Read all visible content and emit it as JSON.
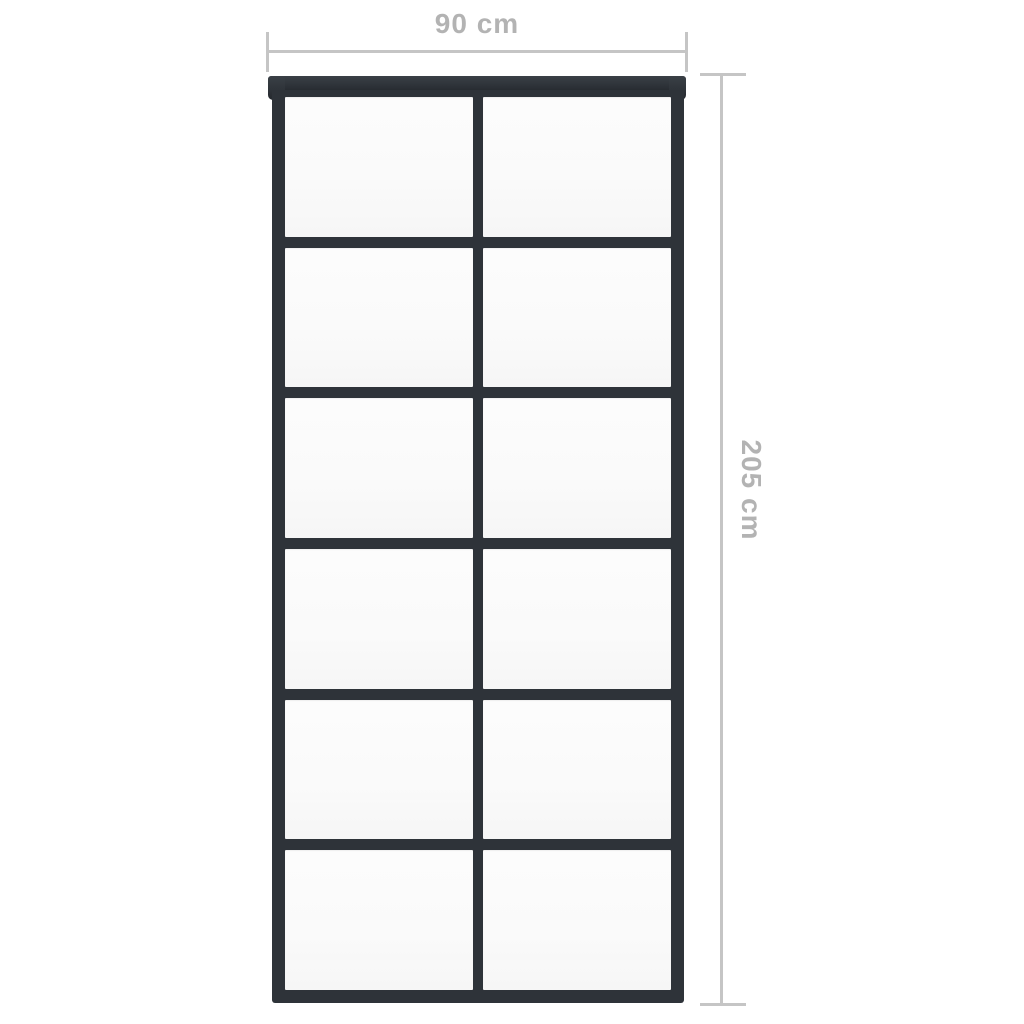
{
  "diagram": {
    "kind": "product-dimension-diagram",
    "subject": "sliding door with black frame and glass panes",
    "grid": {
      "rows": 6,
      "columns": 2,
      "pane_count": 12
    }
  },
  "dimensions": {
    "width": {
      "label": "90 cm",
      "value": 90,
      "unit": "cm",
      "position": "top"
    },
    "height": {
      "label": "205 cm",
      "value": 205,
      "unit": "cm",
      "position": "right"
    }
  },
  "colors": {
    "frame": "#2e3339",
    "frame_light": "#3a4046",
    "frame_dark": "#24282d",
    "glass": "#fafafa",
    "dimension_line": "#c5c5c5",
    "dimension_text": "#b3b3b3",
    "background": "#ffffff"
  }
}
